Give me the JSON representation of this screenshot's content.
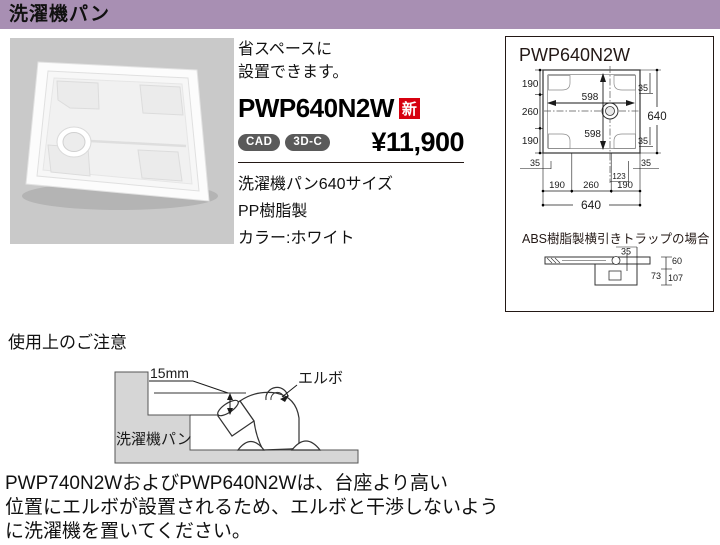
{
  "colors": {
    "header_bg": "#a88fb3",
    "new_badge_bg": "#d7000f",
    "format_badge_bg": "#5a5a5a",
    "photo_bg": "#c9c9c9",
    "diagram_gray": "#d6d6d6"
  },
  "header": {
    "title": "洗濯機パン"
  },
  "product": {
    "tagline": [
      "省スペースに",
      "設置できます。"
    ],
    "code": "PWP640N2W",
    "new_badge": "新",
    "badge_cad": "CAD",
    "badge_3dc": "3D-C",
    "price": "¥11,900",
    "spec_lines": [
      "洗濯機パン640サイズ",
      "PP樹脂製",
      "カラー:ホワイト"
    ]
  },
  "tech_panel": {
    "title": "PWP640N2W",
    "plan": {
      "left_190_top": "190",
      "left_260": "260",
      "left_190_bottom": "190",
      "inner_width_598": "598",
      "inner_height_598": "598",
      "right_640": "640",
      "right_35_top": "35",
      "right_35_bottom": "35",
      "below_35_left": "35",
      "below_35_right": "35",
      "below_123": "123",
      "bottom_190_left": "190",
      "bottom_260": "260",
      "bottom_190_right": "190",
      "bottom_640": "640"
    },
    "trap_caption": "ABS樹脂製横引きトラップの場合",
    "side": {
      "dim_35": "35",
      "dim_60": "60",
      "dim_73": "73",
      "dim_107": "107"
    }
  },
  "notice": {
    "heading": "使用上のご注意",
    "dim_label": "15mm",
    "elbow_label": "エルボ",
    "pan_label": "洗濯機パン",
    "body_lines": [
      "PWP740N2WおよびPWP640N2Wは、台座より高い",
      "位置にエルボが設置されるため、エルボと干渉しないよう",
      "に洗濯機を置いてください。"
    ]
  }
}
